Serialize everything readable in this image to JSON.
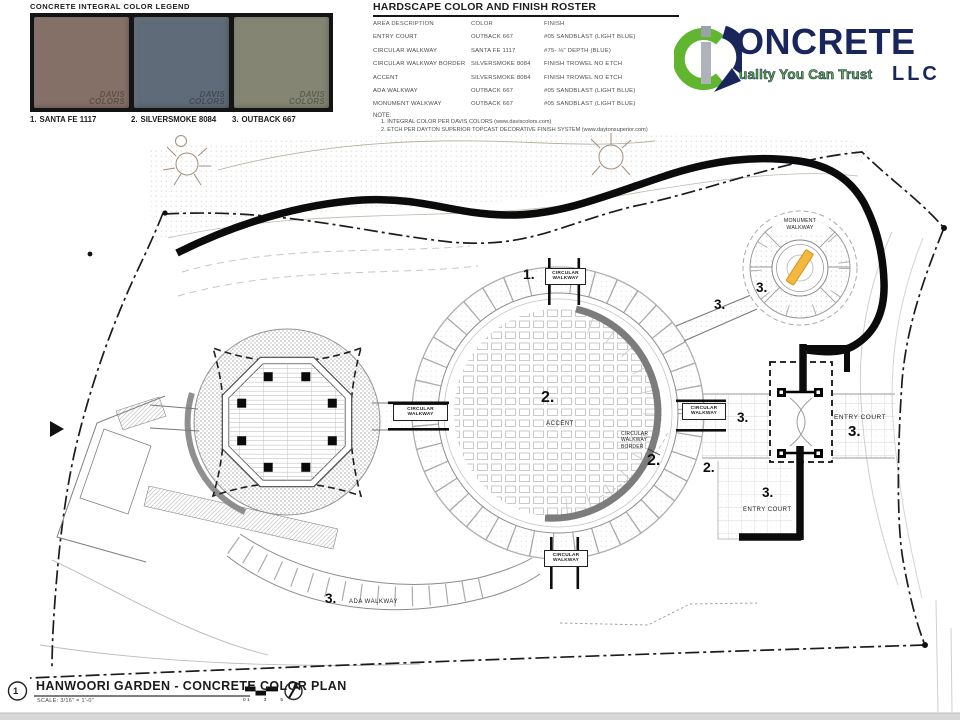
{
  "legend": {
    "title": "CONCRETE INTEGRAL COLOR LEGEND",
    "brand_l1": "DAVIS",
    "brand_l2": "COLORS",
    "swatches": [
      {
        "index": "1.",
        "name": "SANTA FE 1117",
        "color": "#857068"
      },
      {
        "index": "2.",
        "name": "SILVERSMOKE 8084",
        "color": "#5f6b78"
      },
      {
        "index": "3.",
        "name": "OUTBACK 667",
        "color": "#848673"
      }
    ]
  },
  "roster": {
    "title": "HARDSCAPE COLOR AND FINISH ROSTER",
    "headers": [
      "AREA DESCRIPTION",
      "COLOR",
      "FINISH"
    ],
    "rows": [
      [
        "ENTRY COURT",
        "OUTBACK 667",
        "#05 SANDBLAST (LIGHT BLUE)"
      ],
      [
        "CIRCULAR WALKWAY",
        "SANTA FE 1117",
        "#75- ⅛\" DEPTH (BLUE)"
      ],
      [
        "CIRCULAR WALKWAY BORDER",
        "SILVERSMOKE 8084",
        "FINISH TROWEL NO ETCH"
      ],
      [
        "ACCENT",
        "SILVERSMOKE 8084",
        "FINISH TROWEL NO ETCH"
      ],
      [
        "ADA WALKWAY",
        "OUTBACK 667",
        "#05 SANDBLAST (LIGHT BLUE)"
      ],
      [
        "MONUMENT WALKWAY",
        "OUTBACK 667",
        "#05 SANDBLAST (LIGHT BLUE)"
      ]
    ],
    "note_label": "NOTE:",
    "notes": [
      "1.  INTEGRAL COLOR PER DAVIS COLORS (www.daviscolors.com)",
      "2.  ETCH PER DAYTON SUPERIOR TOPCAST DECORATIVE FINISH SYSTEM (www.daytonsuperior.com)"
    ]
  },
  "logo": {
    "word": "ONCRETE",
    "tagline": "uality You Can Trust",
    "suffix": "LLC",
    "green": "#62b62f",
    "navy": "#19265c"
  },
  "plan": {
    "labels": {
      "n1": "1.",
      "n2": "2.",
      "n3": "3.",
      "cw_l1": "CIRCULAR",
      "cw_l2": "WALKWAY",
      "border_l1": "CIRCULAR",
      "border_l2": "WALKWAY",
      "border_l3": "BORDER",
      "accent": "ACCENT",
      "entry_court": "ENTRY COURT",
      "ada": "ADA WALKWAY",
      "mon_l1": "MONUMENT",
      "mon_l2": "WALKWAY"
    }
  },
  "titleblock": {
    "number": "1",
    "title": "HANWOORI GARDEN -  CONCRETE COLOR PLAN",
    "scale": "SCALE:  3/16\" = 1'-0\"",
    "bar_labels": [
      "0 1",
      "3",
      "5"
    ]
  }
}
